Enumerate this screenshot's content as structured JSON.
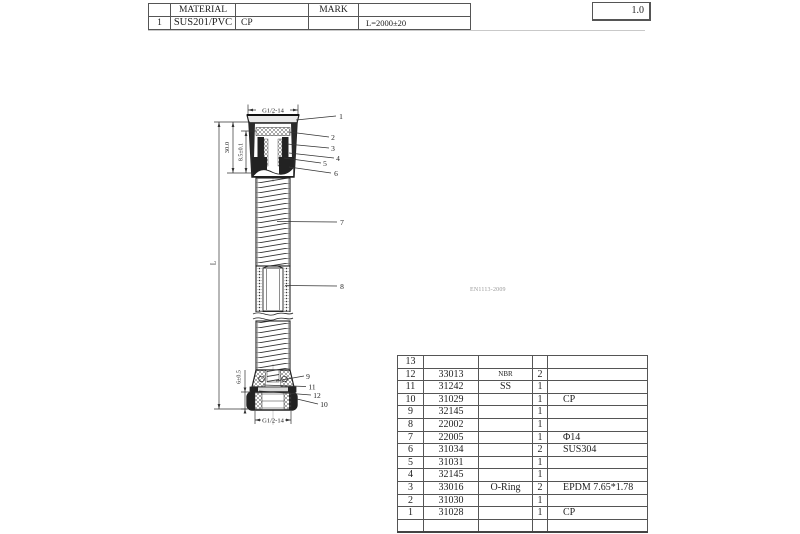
{
  "header_table": {
    "material_header": "MATERIAL",
    "mark_header": "MARK",
    "row": {
      "no": "1",
      "material": "SUS201/PVC",
      "finish": "CP",
      "length_spec": "L=2000±20"
    }
  },
  "scale_box": {
    "value": "1.0"
  },
  "drawing": {
    "standard_note": "EN1113-2009",
    "dimensions": {
      "top_thread": "G1/2-14",
      "bottom_thread": "G1/2-14",
      "connector_height": "30.0",
      "cone_depth": "8.5±0.1",
      "nut_height": "6±0.5",
      "hose_length": "L"
    },
    "callouts": [
      "1",
      "2",
      "3",
      "4",
      "5",
      "6",
      "7",
      "8",
      "9",
      "10",
      "11",
      "12"
    ]
  },
  "parts_table": {
    "rows": [
      {
        "no": "13",
        "code": "",
        "name": "",
        "qty": "",
        "remark": ""
      },
      {
        "no": "12",
        "code": "33013",
        "name": "NBR",
        "qty": "2",
        "remark": ""
      },
      {
        "no": "11",
        "code": "31242",
        "name": "SS",
        "qty": "1",
        "remark": ""
      },
      {
        "no": "10",
        "code": "31029",
        "name": "",
        "qty": "1",
        "remark": "CP"
      },
      {
        "no": "9",
        "code": "32145",
        "name": "",
        "qty": "1",
        "remark": ""
      },
      {
        "no": "8",
        "code": "22002",
        "name": "",
        "qty": "1",
        "remark": ""
      },
      {
        "no": "7",
        "code": "22005",
        "name": "",
        "qty": "1",
        "remark": "Φ14"
      },
      {
        "no": "6",
        "code": "31034",
        "name": "",
        "qty": "2",
        "remark": "SUS304"
      },
      {
        "no": "5",
        "code": "31031",
        "name": "",
        "qty": "1",
        "remark": ""
      },
      {
        "no": "4",
        "code": "32145",
        "name": "",
        "qty": "1",
        "remark": ""
      },
      {
        "no": "3",
        "code": "33016",
        "name": "O-Ring",
        "qty": "2",
        "remark": "EPDM 7.65*1.78"
      },
      {
        "no": "2",
        "code": "31030",
        "name": "",
        "qty": "1",
        "remark": ""
      },
      {
        "no": "1",
        "code": "31028",
        "name": "",
        "qty": "1",
        "remark": "CP"
      },
      {
        "no": "",
        "code": "",
        "name": "",
        "qty": "",
        "remark": ""
      }
    ]
  }
}
